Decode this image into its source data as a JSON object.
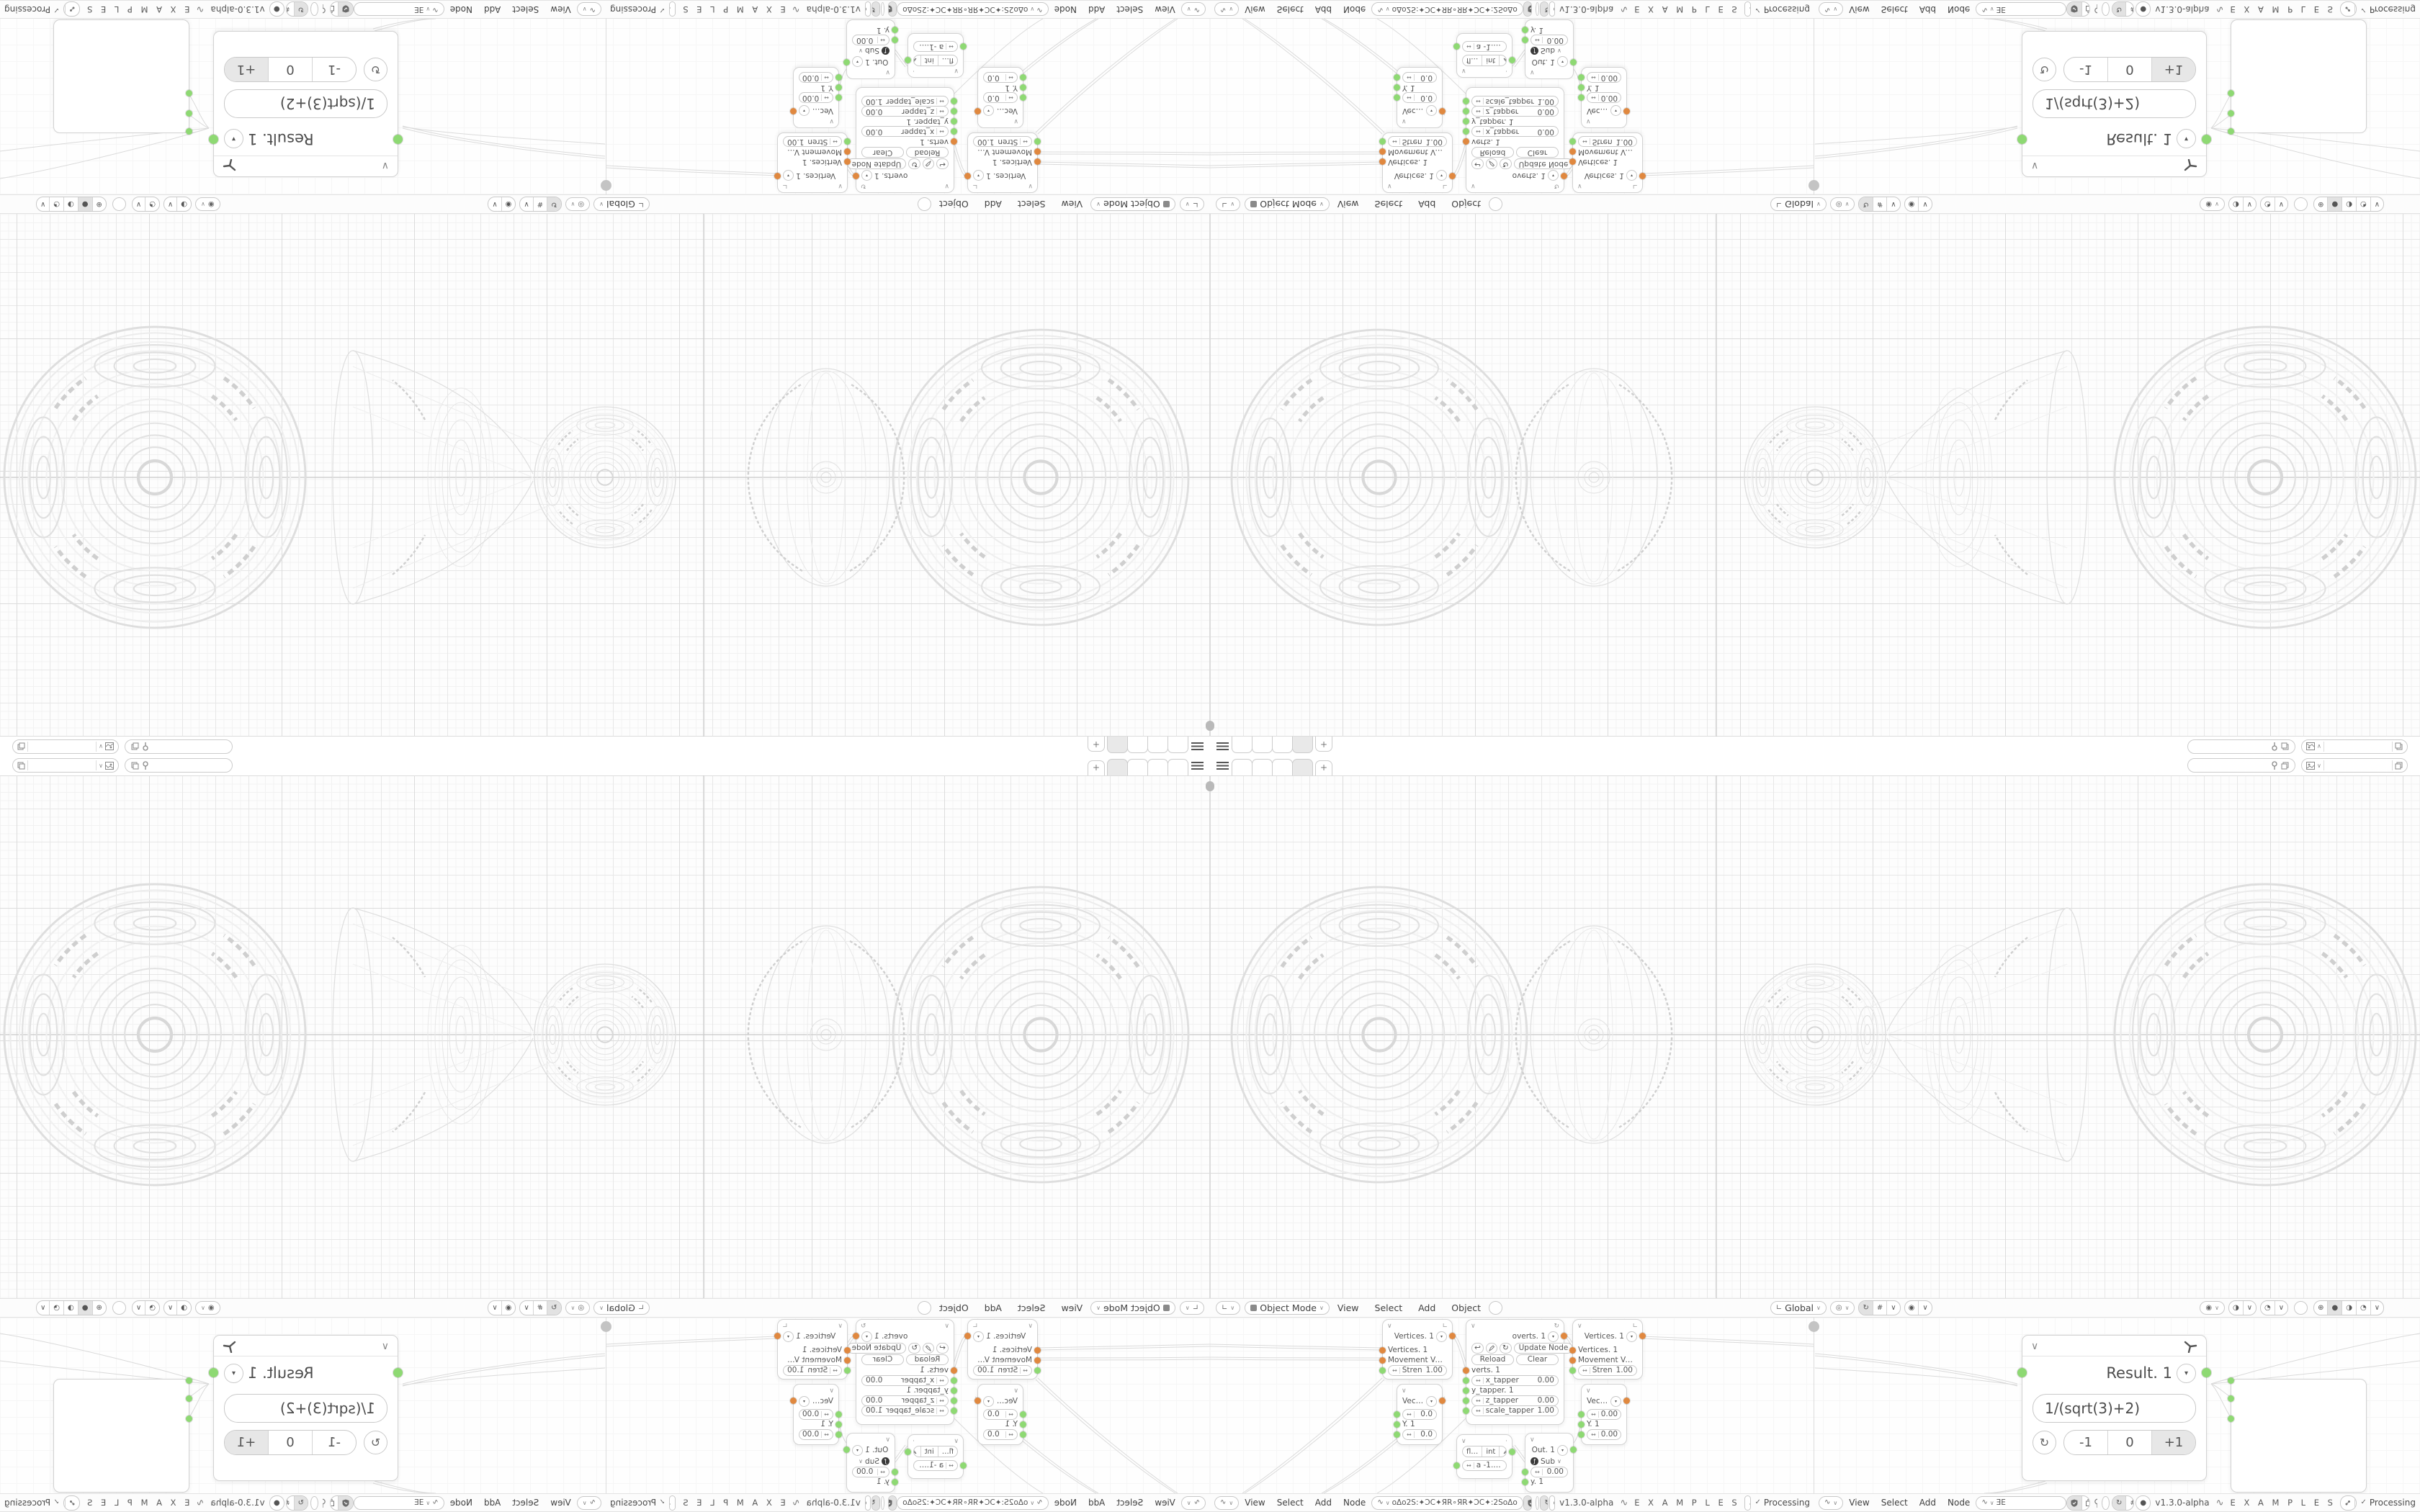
{
  "app": {
    "version": "v1.3.0-alpha",
    "brand": "E X A M P L E S",
    "status": "Processing"
  },
  "topbar": {
    "new_tab": "+"
  },
  "viewport_header": {
    "mode": "Object Mode",
    "menus": [
      "View",
      "Select",
      "Add",
      "Object"
    ],
    "orientation": "Global"
  },
  "node_header": {
    "menus": [
      "View",
      "Select",
      "Add",
      "Node"
    ],
    "tree_left": "oΔo2S:✦ƆC✦ЯR∘ЯR✦ƆC✦:2SoΔo",
    "tree_right": "ƎE"
  },
  "nodes": {
    "vertices": {
      "title": "Vertices. 1",
      "in1": "Vertices. 1",
      "in2": "Movement Vecto…",
      "stren_label": "Stren",
      "stren_value": "1.00"
    },
    "overts": {
      "title": "overts. 1",
      "update": "Update Node",
      "reload": "Reload",
      "clear": "Clear",
      "verts": "verts. 1",
      "x_label": "x_tapper",
      "x_value": "0.00",
      "y_label": "y_tapper. 1",
      "z_label": "z_tapper",
      "z_value": "0.00",
      "scale_label": "scale_tapper",
      "scale_value": "1.00"
    },
    "vector_left": {
      "title": "Vector…",
      "v1": "0.0",
      "y": "Y. 1",
      "v2": "0.0"
    },
    "vector_right": {
      "title": "Vector…",
      "v1": "0.00",
      "y": "Y. 1",
      "v2": "0.00"
    },
    "floatint": {
      "seg_float": "fl…",
      "seg_int": "int",
      "a_value": "a  -1.00"
    },
    "out": {
      "title": "Out. 1",
      "op": "Sub",
      "value": "0.00",
      "y": "y. 1"
    },
    "result": {
      "title": "Result. 1",
      "formula": "1/(sqrt(3)+2)",
      "dec": "-1",
      "zero": "0",
      "inc": "+1"
    }
  },
  "icons": {
    "chevron": "∨",
    "dropdown": "▾",
    "check": "✓",
    "close": "×",
    "undo": "↩",
    "refresh": "↻",
    "wave": "∿",
    "hash": "#",
    "link": "↔",
    "angle": "∟",
    "prop": "◉",
    "dot": "·",
    "globe": "⊕",
    "solid": "●",
    "half": "◑",
    "quarter": "◔",
    "fn": "ƒ",
    "eye": "◉",
    "pivot": "◎"
  },
  "colors": {
    "socket_orange": "#e0883f",
    "socket_green": "#8ed973",
    "accent_gray": "#e2e2e2"
  }
}
